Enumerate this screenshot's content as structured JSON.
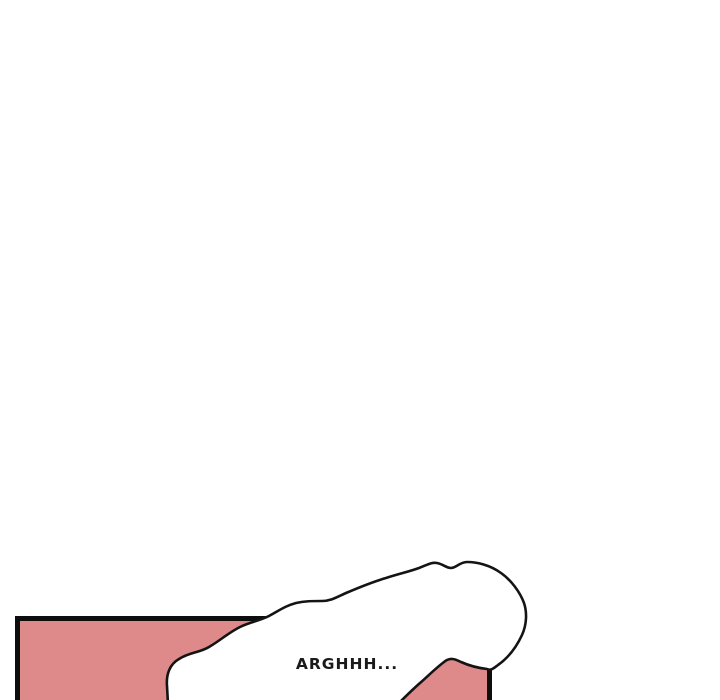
{
  "page": {
    "background_color": "#ffffff"
  },
  "panel": {
    "fill_color": "#df8a8a",
    "border_color": "#0d0d0d",
    "speech_bubble": {
      "text": "ARGHHH...",
      "fill_color": "#ffffff",
      "stroke_color": "#141414",
      "text_color": "#1a1a1a"
    }
  }
}
